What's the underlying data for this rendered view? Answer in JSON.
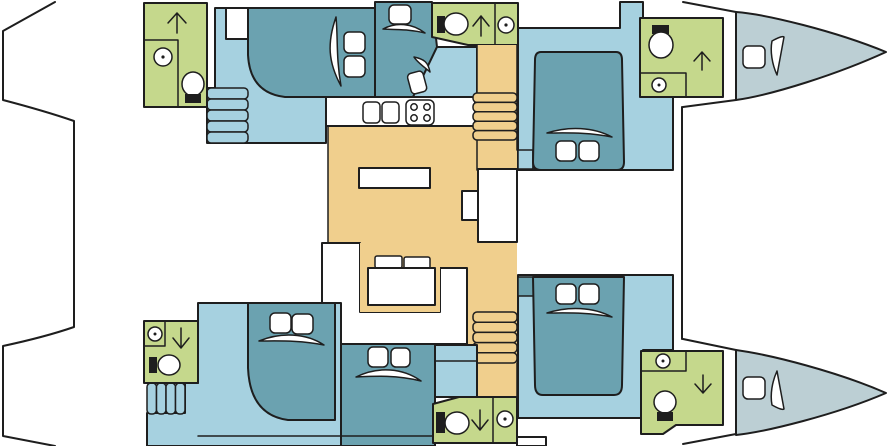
{
  "visible_text": [],
  "diagram": {
    "kind": "catamaran-yacht-floor-plan",
    "orientation": "bow-right-stern-left",
    "hulls": [
      {
        "id": "port-hull-top",
        "rooms": [
          {
            "id": "bathroom-port-aft",
            "kind": "bathroom",
            "features": [
              "shower-stall",
              "toilet",
              "companionway-arrow-up"
            ]
          },
          {
            "id": "cabin-port-aft",
            "kind": "cabin",
            "features": [
              "double-bed",
              "two-pillows",
              "hull-window",
              "entry-stairs"
            ]
          },
          {
            "id": "cabin-port-mid",
            "kind": "cabin",
            "features": [
              "berth",
              "pillow",
              "hull-window",
              "angled-berth",
              "pillow"
            ]
          },
          {
            "id": "bathroom-port-mid",
            "kind": "bathroom",
            "features": [
              "toilet",
              "companionway-arrow-up",
              "shower-stall"
            ]
          },
          {
            "id": "cabin-port-forward",
            "kind": "cabin",
            "features": [
              "island-double-bed",
              "two-pillows",
              "hull-window"
            ]
          },
          {
            "id": "bathroom-port-bow",
            "kind": "bathroom",
            "features": [
              "toilet",
              "shower-stall",
              "companionway-arrow-up"
            ]
          },
          {
            "id": "bow-cabin-port",
            "kind": "crew-berth",
            "features": [
              "pillow",
              "hull-window"
            ]
          }
        ]
      },
      {
        "id": "starboard-hull-bottom",
        "rooms": [
          {
            "id": "bathroom-starboard-aft",
            "kind": "bathroom",
            "features": [
              "shower-stall",
              "companionway-arrow-down",
              "toilet",
              "entry-stairs"
            ]
          },
          {
            "id": "cabin-starboard-aft",
            "kind": "cabin",
            "features": [
              "double-bed",
              "two-pillows",
              "hull-window"
            ]
          },
          {
            "id": "cabin-starboard-mid",
            "kind": "cabin",
            "features": [
              "double-bed",
              "two-pillows",
              "hull-window"
            ]
          },
          {
            "id": "bathroom-starboard-mid",
            "kind": "bathroom",
            "features": [
              "toilet",
              "companionway-arrow-down",
              "shower-stall"
            ]
          },
          {
            "id": "cabin-starboard-forward",
            "kind": "cabin",
            "features": [
              "island-double-bed",
              "two-pillows",
              "hull-window"
            ]
          },
          {
            "id": "bathroom-starboard-bow",
            "kind": "bathroom",
            "features": [
              "shower-stall",
              "companionway-arrow-down",
              "toilet"
            ]
          },
          {
            "id": "bow-cabin-starboard",
            "kind": "crew-berth",
            "features": [
              "pillow",
              "hull-window"
            ]
          }
        ]
      }
    ],
    "bridgedeck": {
      "id": "salon",
      "features": [
        "galley-counter",
        "double-sink",
        "stove-4-burner",
        "galley-island",
        "nav-desk",
        "u-shaped-sofa",
        "salon-table",
        "two-cushions",
        "stairs-port",
        "stairs-starboard"
      ]
    },
    "icon_legend": {
      "shower": "circle-with-center-dot",
      "toilet": "ellipse-bowl-with-black-tank",
      "companionway-arrow": "thin-line-arrow",
      "stove": "rounded-square-with-4-burner-circles",
      "sink": "rounded-square-pair",
      "hull-window": "white-crescent-outline",
      "stairs": "stacked-rounded-treads"
    }
  },
  "colors": {
    "outline": "#1e1e1e",
    "hull_white": "#ffffff",
    "cabin_floor": "#a6d1e0",
    "bed_teal": "#6ba2b0",
    "bathroom_green": "#c5d88c",
    "salon_tan": "#f0cf8d",
    "bow_gray": "#bccfd4"
  }
}
